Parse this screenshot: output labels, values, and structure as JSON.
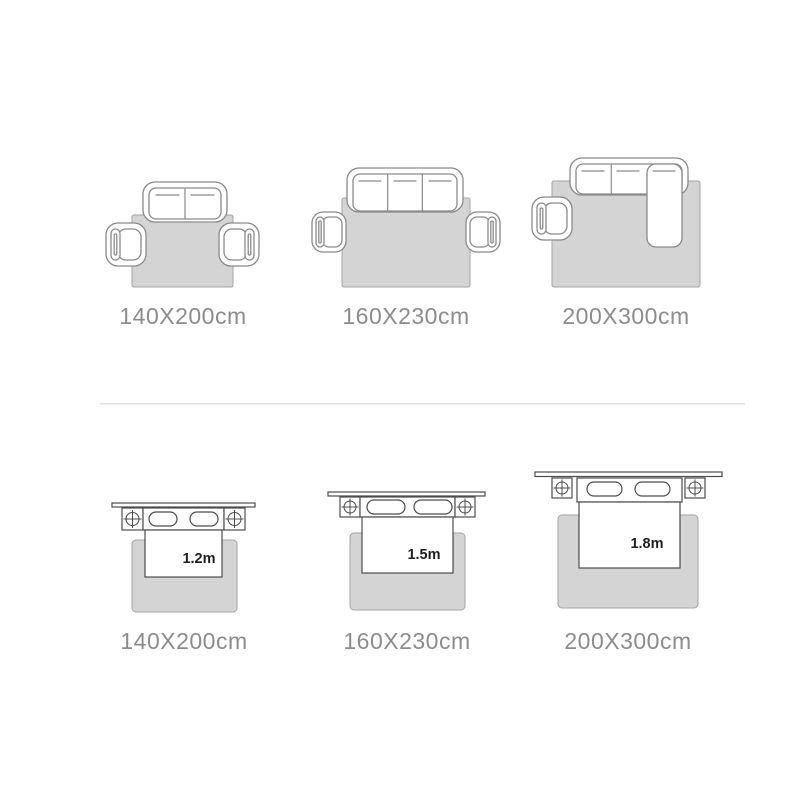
{
  "colors": {
    "background": "#ffffff",
    "furniture_fill": "#ffffff",
    "rug_fill": "#d4d4d4",
    "rug_stroke": "#a3a3a3",
    "sofa_stroke": "#8a8a8a",
    "bed_stroke": "#4d4d4d",
    "divider": "#e3e3e3",
    "dim_label_text": "#8c8c8c",
    "bed_size_text": "#1f1f1f"
  },
  "sofa_layouts": {
    "items": [
      {
        "label": "140X200cm",
        "icon": "loveseat-with-two-armchairs"
      },
      {
        "label": "160X230cm",
        "icon": "three-seat-sofa-with-two-armchairs"
      },
      {
        "label": "200X300cm",
        "icon": "l-sectional-sofa-with-armchair"
      }
    ]
  },
  "bed_layouts": {
    "items": [
      {
        "label": "140X200cm",
        "bed_size": "1.2m"
      },
      {
        "label": "160X230cm",
        "bed_size": "1.5m"
      },
      {
        "label": "200X300cm",
        "bed_size": "1.8m"
      }
    ]
  }
}
